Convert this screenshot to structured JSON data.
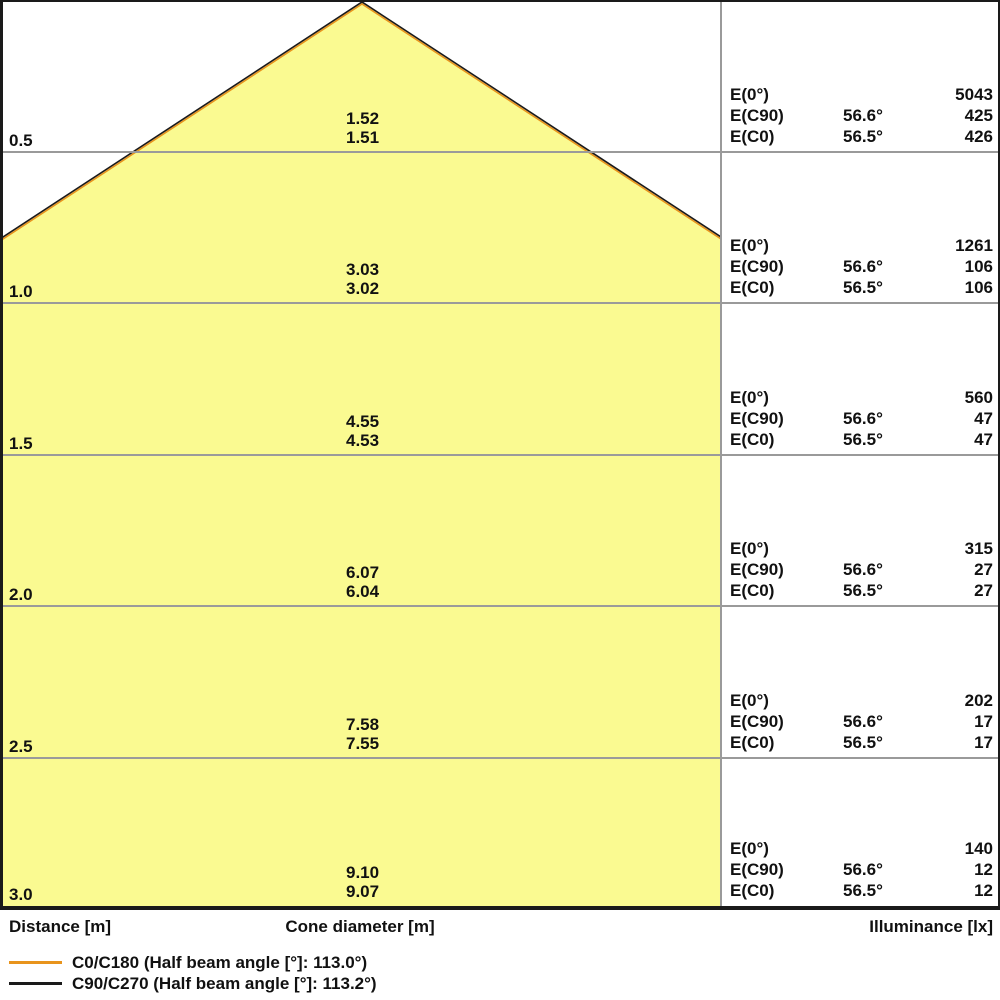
{
  "chart_data": {
    "type": "cone-diagram",
    "description": "Light cone diagram: beam diameter and illuminance versus distance",
    "axis": {
      "distances_m": [
        0.5,
        1.0,
        1.5,
        2.0,
        2.5,
        3.0
      ],
      "distance_axis_label": "Distance [m]",
      "cone_axis_label": "Cone diameter [m]",
      "illuminance_axis_label": "Illuminance [lx]"
    },
    "colors": {
      "cone_fill": "#FAFA91",
      "c0_beam_line": "#E8941C",
      "c90_beam_line": "#1A1A1A",
      "grid_line": "#9A9A9A"
    },
    "rows": [
      {
        "distance_label": "0.5",
        "cone_diameter_c90": "1.52",
        "cone_diameter_c0": "1.51",
        "e0_label": "E(0°)",
        "e0_value": "5043",
        "ec90_label": "E(C90)",
        "ec90_angle": "56.6°",
        "ec90_value": "425",
        "ec0_label": "E(C0)",
        "ec0_angle": "56.5°",
        "ec0_value": "426"
      },
      {
        "distance_label": "1.0",
        "cone_diameter_c90": "3.03",
        "cone_diameter_c0": "3.02",
        "e0_label": "E(0°)",
        "e0_value": "1261",
        "ec90_label": "E(C90)",
        "ec90_angle": "56.6°",
        "ec90_value": "106",
        "ec0_label": "E(C0)",
        "ec0_angle": "56.5°",
        "ec0_value": "106"
      },
      {
        "distance_label": "1.5",
        "cone_diameter_c90": "4.55",
        "cone_diameter_c0": "4.53",
        "e0_label": "E(0°)",
        "e0_value": "560",
        "ec90_label": "E(C90)",
        "ec90_angle": "56.6°",
        "ec90_value": "47",
        "ec0_label": "E(C0)",
        "ec0_angle": "56.5°",
        "ec0_value": "47"
      },
      {
        "distance_label": "2.0",
        "cone_diameter_c90": "6.07",
        "cone_diameter_c0": "6.04",
        "e0_label": "E(0°)",
        "e0_value": "315",
        "ec90_label": "E(C90)",
        "ec90_angle": "56.6°",
        "ec90_value": "27",
        "ec0_label": "E(C0)",
        "ec0_angle": "56.5°",
        "ec0_value": "27"
      },
      {
        "distance_label": "2.5",
        "cone_diameter_c90": "7.58",
        "cone_diameter_c0": "7.55",
        "e0_label": "E(0°)",
        "e0_value": "202",
        "ec90_label": "E(C90)",
        "ec90_angle": "56.6°",
        "ec90_value": "17",
        "ec0_label": "E(C0)",
        "ec0_angle": "56.5°",
        "ec0_value": "17"
      },
      {
        "distance_label": "3.0",
        "cone_diameter_c90": "9.10",
        "cone_diameter_c0": "9.07",
        "e0_label": "E(0°)",
        "e0_value": "140",
        "ec90_label": "E(C90)",
        "ec90_angle": "56.6°",
        "ec90_value": "12",
        "ec0_label": "E(C0)",
        "ec0_angle": "56.5°",
        "ec0_value": "12"
      }
    ],
    "legend": [
      {
        "label": "C0/C180 (Half beam angle [°]: 113.0°)",
        "color": "#E8941C"
      },
      {
        "label": "C90/C270 (Half beam angle [°]: 113.2°)",
        "color": "#1A1A1A"
      }
    ]
  }
}
